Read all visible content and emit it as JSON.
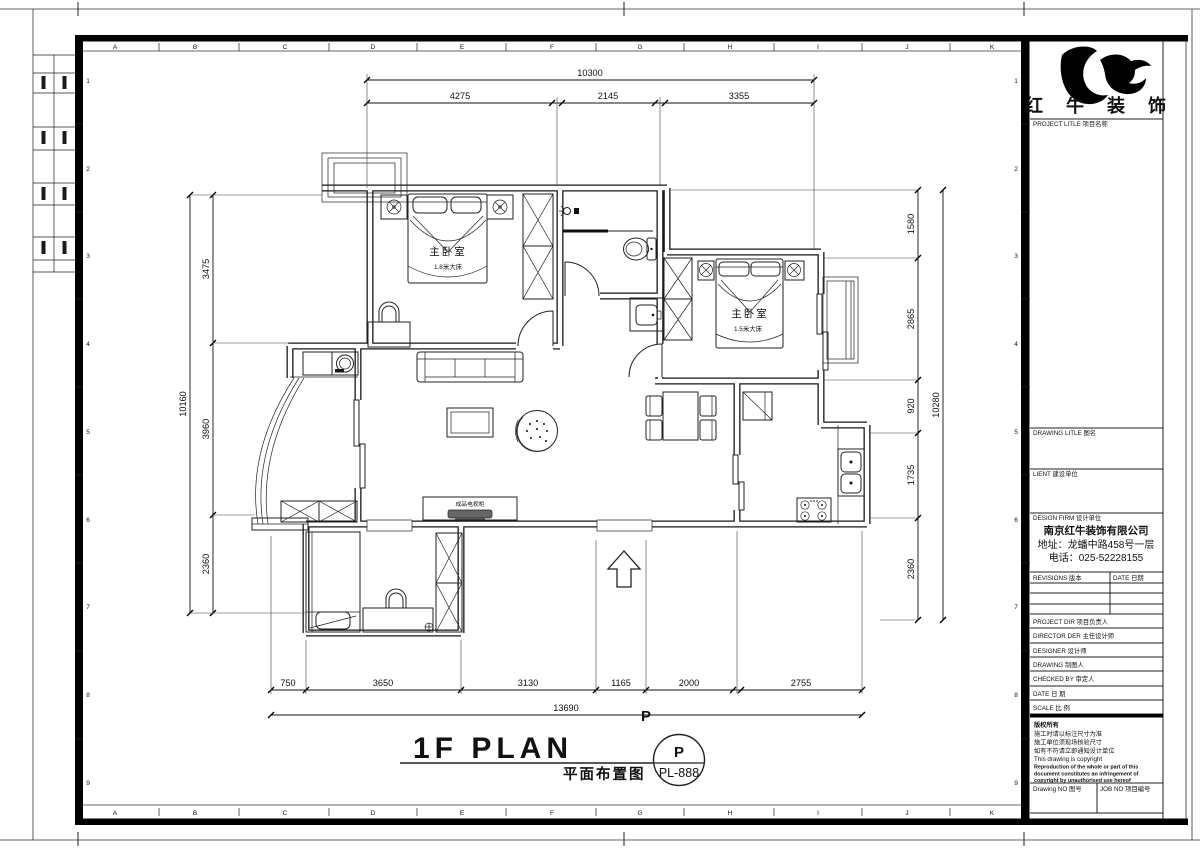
{
  "sheet": {
    "grid_letters": [
      "A",
      "B",
      "C",
      "D",
      "E",
      "F",
      "G",
      "H",
      "I",
      "J",
      "K"
    ],
    "grid_numbers": [
      "1",
      "2",
      "3",
      "4",
      "5",
      "6",
      "7",
      "8",
      "9"
    ]
  },
  "dims": {
    "top": {
      "overall": "10300",
      "segments": [
        "4275",
        "2145",
        "3355"
      ]
    },
    "bottom": {
      "overall": "13690",
      "marker": "P",
      "segments": [
        "750",
        "3650",
        "3130",
        "1165",
        "2000",
        "2755"
      ]
    },
    "left": {
      "overall": "10160",
      "segments": [
        "3475",
        "3960",
        "2360"
      ]
    },
    "right": {
      "overall": "10280",
      "segments": [
        "1580",
        "2865",
        "920",
        "1735",
        "2360"
      ]
    }
  },
  "plan": {
    "bedroom1": {
      "name": "主卧室",
      "bed": "1.8米大床"
    },
    "bedroom2": {
      "name": "主卧室",
      "bed": "1.5米大床"
    },
    "tv_label": "成品电视柜",
    "title_en": "1F PLAN",
    "title_cn": "平面布置图",
    "stamp_letter": "P",
    "stamp_code": "PL-888"
  },
  "panel": {
    "logo_text": "红 牛 装 饰",
    "project": "PROJECT LITLE  项目名称",
    "drawing_title": "DRAWING LITLE  图名",
    "client": "LIENT  建设单位",
    "design_firm": "DESIGN FIRM  设计单位",
    "firm_name": "南京红牛装饰有限公司",
    "firm_addr": "地址：龙蟠中路458号一层",
    "firm_phone": "电话：025-52228155",
    "revisions": "REVISIONS  版本",
    "date_col": "DATE 日期",
    "staff": [
      "PROJECT DIR  项目负责人",
      "DIRECTOR DER 主任设计师",
      "DESIGNER   设计师",
      "DRAWING    制图人",
      "CHECKED BY  审定人",
      "DATE      日 期",
      "SCALE     比 例"
    ],
    "copyright": [
      "版权所有",
      "施工时请以标注尺寸为准",
      "施工单位须现场核验尺寸",
      "如有不符请立即通知设计单位",
      "This drawing is copyright",
      "Reproduction of the whole or part of this",
      "document constitutes an infringement of",
      "copyright by unauthorised use hereof"
    ],
    "drawing_no": "Drawing NO 图号",
    "job_no": "JOB NO 项目编号"
  }
}
